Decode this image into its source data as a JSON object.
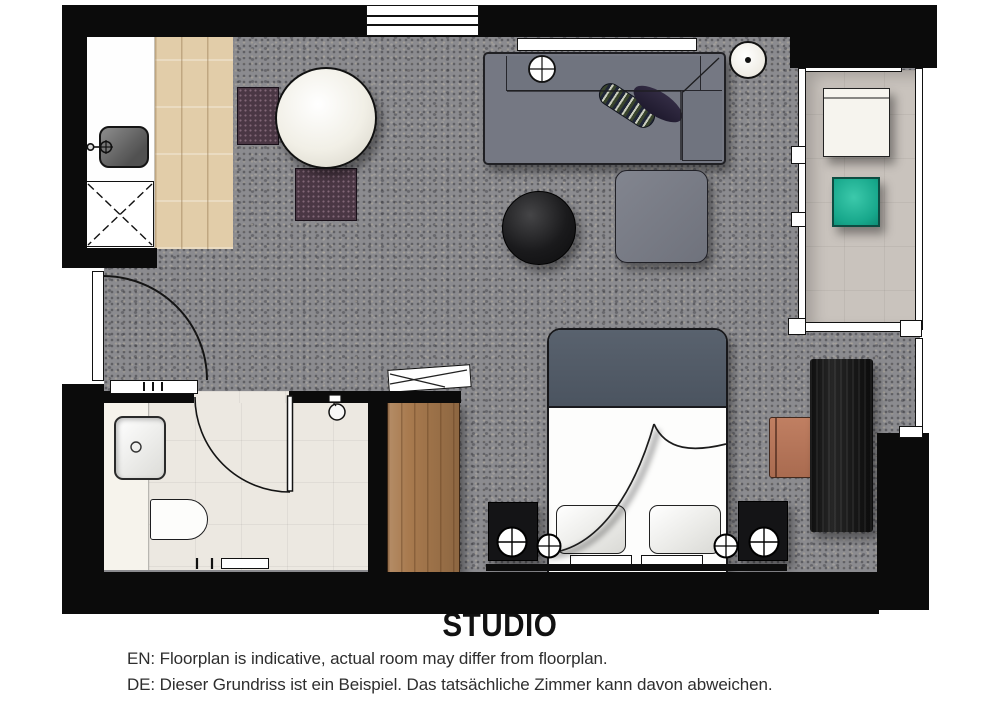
{
  "title": "STUDIO",
  "notes": {
    "en": "EN: Floorplan is indicative, actual room may differ from floorplan.",
    "de": "DE: Dieser Grundriss ist ein Beispiel. Das tatsächliche Zimmer kann davon abweichen."
  },
  "palette": {
    "wall": "#0b0b0b",
    "carpet": "#8b8b8f",
    "wood_floor": "#e2cda9",
    "bathroom_floor": "#ece8e1",
    "balcony_floor": "#c9c3bd",
    "sofa": "#757883",
    "bed_duvet": "#525b67",
    "accent_teal": "#21b99c",
    "accent_copper": "#bd7c5f",
    "wardrobe_wood": "#a87a4e",
    "dining_chair": "#4a3744"
  },
  "rooms": [
    {
      "name": "living-sleeping-area"
    },
    {
      "name": "kitchenette"
    },
    {
      "name": "bathroom"
    },
    {
      "name": "balcony"
    },
    {
      "name": "entrance"
    }
  ],
  "furniture": [
    "kitchen counter with sink",
    "appliance",
    "round dining table",
    "two dining chairs",
    "sofa with chaise",
    "two cushions",
    "round coffee table",
    "ottoman",
    "floor lamp",
    "console shelf",
    "double bed",
    "two pillows",
    "two nightstands with lamps",
    "two reading lamps",
    "desk",
    "desk chair",
    "wardrobe",
    "luggage rack",
    "washbasin",
    "toilet",
    "shower",
    "balcony chair",
    "balcony side table"
  ]
}
